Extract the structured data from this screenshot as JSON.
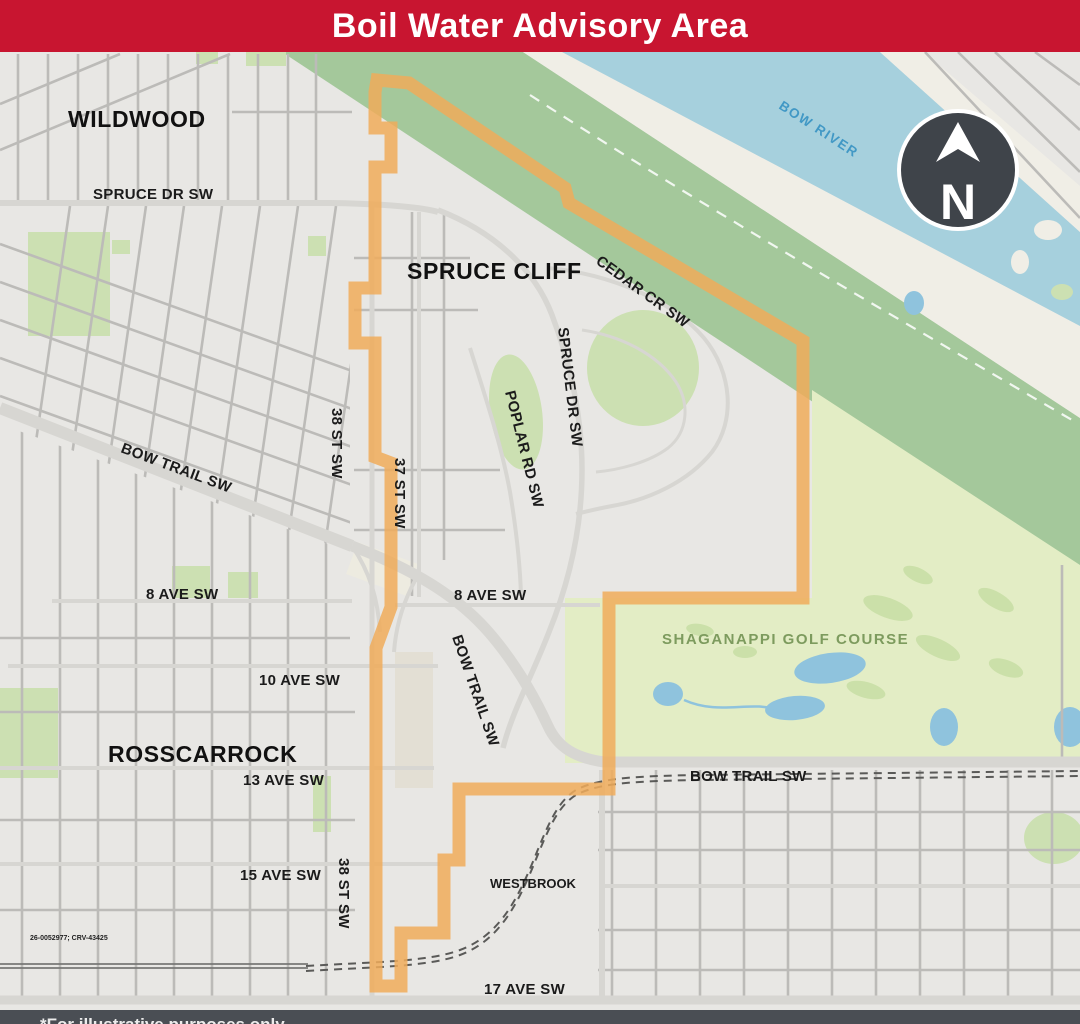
{
  "header": {
    "title": "Boil Water Advisory Area"
  },
  "compass": {
    "letter": "N"
  },
  "map": {
    "ref_code": "26-0052977; CRV-43425",
    "labels": [
      {
        "text": "WILDWOOD"
      },
      {
        "text": "SPRUCE DR SW"
      },
      {
        "text": "SPRUCE CLIFF"
      },
      {
        "text": "CEDAR CR SW"
      },
      {
        "text": "SPRUCE DR SW"
      },
      {
        "text": "POPLAR RD SW"
      },
      {
        "text": "BOW RIVER"
      },
      {
        "text": "38 ST SW"
      },
      {
        "text": "37 ST SW"
      },
      {
        "text": "BOW TRAIL SW"
      },
      {
        "text": "8 AVE SW"
      },
      {
        "text": "8 AVE SW"
      },
      {
        "text": "BOW TRAIL SW"
      },
      {
        "text": "SHAGANAPPI GOLF COURSE"
      },
      {
        "text": "BOW TRAIL SW"
      },
      {
        "text": "10 AVE SW"
      },
      {
        "text": "ROSSCARROCK"
      },
      {
        "text": "13 AVE SW"
      },
      {
        "text": "15 AVE SW"
      },
      {
        "text": "38 ST SW"
      },
      {
        "text": "WESTBROOK"
      },
      {
        "text": "17 AVE SW"
      }
    ]
  },
  "footer": {
    "note": "*For illustrative purposes only"
  },
  "colors": {
    "header_red": "#c81530",
    "advisory_orange": "#f0ac5a",
    "river_blue": "#a6d0dd",
    "pond_blue": "#8fc3dd",
    "riverbank_green": "#a4c89b",
    "golf_green": "#e3edc5",
    "park_green": "#cce0b2",
    "road_gray": "#bcbbb8",
    "footer_gray": "#4a4e54",
    "compass_dark": "#3f444a"
  }
}
